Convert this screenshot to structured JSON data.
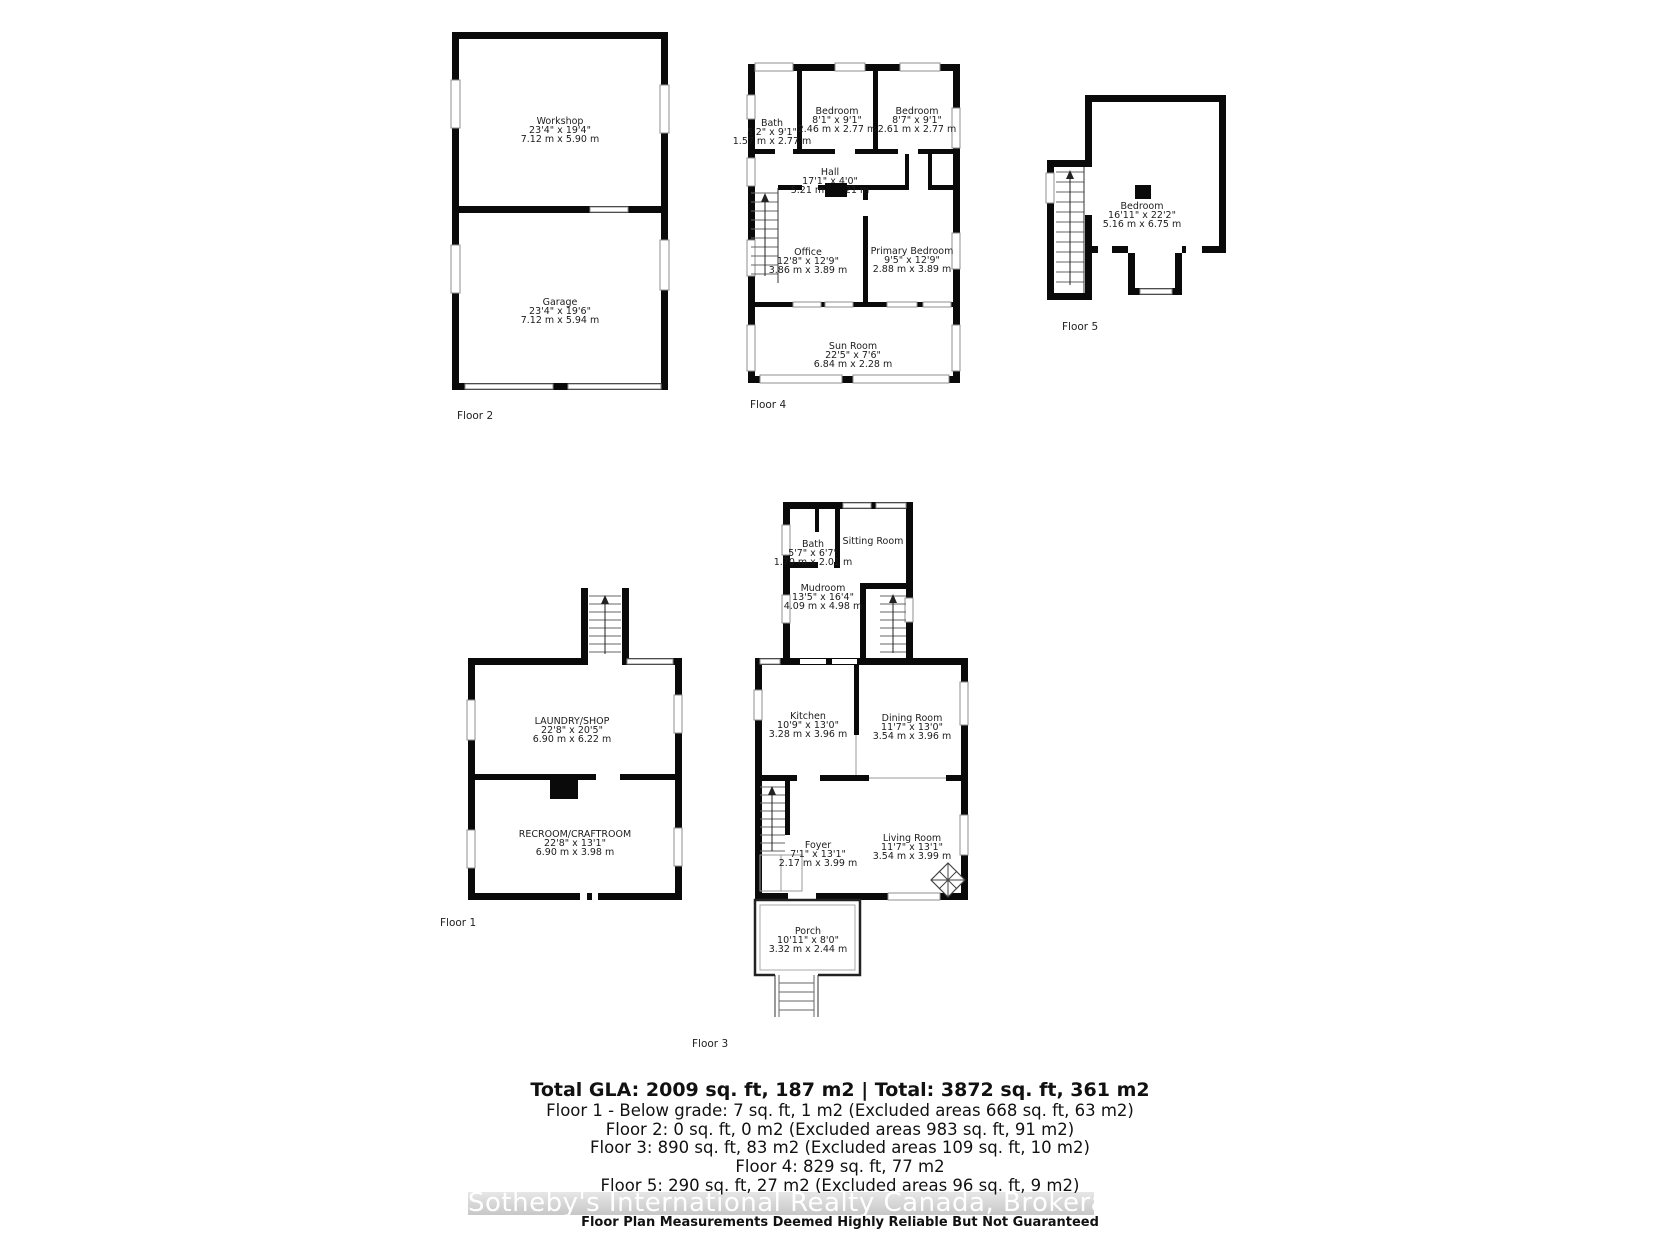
{
  "plans": {
    "floor1": {
      "label": "Floor 1",
      "rooms": {
        "laundry": {
          "name": "LAUNDRY/SHOP",
          "imperial": "22'8\" x 20'5\"",
          "metric": "6.90 m x 6.22 m"
        },
        "recroom": {
          "name": "RECROOM/CRAFTROOM",
          "imperial": "22'8\" x 13'1\"",
          "metric": "6.90 m x 3.98 m"
        }
      }
    },
    "floor2": {
      "label": "Floor 2",
      "rooms": {
        "workshop": {
          "name": "Workshop",
          "imperial": "23'4\" x 19'4\"",
          "metric": "7.12 m x 5.90 m"
        },
        "garage": {
          "name": "Garage",
          "imperial": "23'4\" x 19'6\"",
          "metric": "7.12 m x 5.94 m"
        }
      }
    },
    "floor3": {
      "label": "Floor 3",
      "rooms": {
        "bath": {
          "name": "Bath",
          "imperial": "5'7\" x 6'7\"",
          "metric": "1.70 m x 2.01 m"
        },
        "sitting": {
          "name": "Sitting Room"
        },
        "mudroom": {
          "name": "Mudroom",
          "imperial": "13'5\" x 16'4\"",
          "metric": "4.09 m x 4.98 m"
        },
        "kitchen": {
          "name": "Kitchen",
          "imperial": "10'9\" x 13'0\"",
          "metric": "3.28 m x 3.96 m"
        },
        "dining": {
          "name": "Dining Room",
          "imperial": "11'7\" x 13'0\"",
          "metric": "3.54 m x 3.96 m"
        },
        "foyer": {
          "name": "Foyer",
          "imperial": "7'1\" x 13'1\"",
          "metric": "2.17 m x 3.99 m"
        },
        "living": {
          "name": "Living Room",
          "imperial": "11'7\" x 13'1\"",
          "metric": "3.54 m x 3.99 m"
        },
        "porch": {
          "name": "Porch",
          "imperial": "10'11\" x 8'0\"",
          "metric": "3.32 m x 2.44 m"
        }
      }
    },
    "floor4": {
      "label": "Floor 4",
      "rooms": {
        "bath": {
          "name": "Bath",
          "imperial": "5'2\" x 9'1\"",
          "metric": "1.57 m x 2.77 m"
        },
        "bedroom1": {
          "name": "Bedroom",
          "imperial": "8'1\" x 9'1\"",
          "metric": "2.46 m x 2.77 m"
        },
        "bedroom2": {
          "name": "Bedroom",
          "imperial": "8'7\" x 9'1\"",
          "metric": "2.61 m x 2.77 m"
        },
        "hall": {
          "name": "Hall",
          "imperial": "17'1\" x 4'0\"",
          "metric": "5.21 m x 1.21 m"
        },
        "office": {
          "name": "Office",
          "imperial": "12'8\" x 12'9\"",
          "metric": "3.86 m x 3.89 m"
        },
        "primary": {
          "name": "Primary Bedroom",
          "imperial": "9'5\" x 12'9\"",
          "metric": "2.88 m x 3.89 m"
        },
        "sunroom": {
          "name": "Sun Room",
          "imperial": "22'5\" x 7'6\"",
          "metric": "6.84 m x 2.28 m"
        }
      }
    },
    "floor5": {
      "label": "Floor 5",
      "rooms": {
        "bedroom": {
          "name": "Bedroom",
          "imperial": "16'11\" x 22'2\"",
          "metric": "5.16 m x 6.75 m"
        }
      }
    }
  },
  "summary": {
    "total": "Total GLA: 2009 sq. ft, 187 m2 | Total: 3872 sq. ft, 361 m2",
    "floor1": "Floor 1 - Below grade: 7 sq. ft, 1 m2 (Excluded areas 668 sq. ft, 63 m2)",
    "floor2": "Floor 2: 0 sq. ft, 0 m2 (Excluded areas 983 sq. ft, 91 m2)",
    "floor3": "Floor 3: 890 sq. ft, 83 m2 (Excluded areas 109 sq. ft, 10 m2)",
    "floor4": "Floor 4: 829 sq. ft, 77 m2",
    "floor5": "Floor 5: 290 sq. ft, 27 m2 (Excluded areas 96 sq. ft, 9 m2)"
  },
  "watermark": "Sotheby's International Realty Canada, Brokerage",
  "disclaimer": "Floor Plan Measurements Deemed Highly Reliable But Not Guaranteed"
}
